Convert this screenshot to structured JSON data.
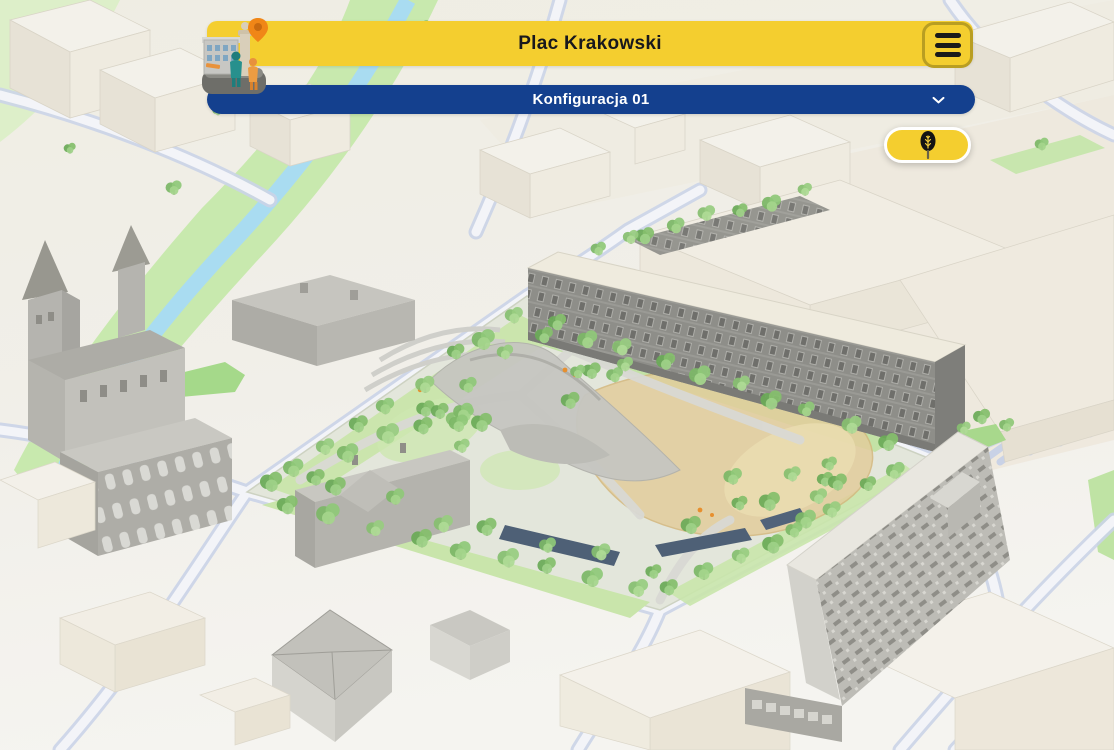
{
  "header": {
    "title": "Plac Krakowski",
    "logo_icon": "3d-city-model-logo",
    "menu_icon": "hamburger-menu-icon"
  },
  "config_selector": {
    "label": "Konfiguracja 01",
    "chevron_icon": "chevron-down-icon"
  },
  "map_controls": {
    "vegetation_button_icon": "tree-icon"
  },
  "map": {
    "view": "3D isometric city model of Plac Krakowski park and surrounding streets"
  },
  "colors": {
    "accent_yellow": "#F4CE2F",
    "accent_navy": "#14408E",
    "title_text": "#18181D",
    "menu_button_border": "#B99E22",
    "config_text": "#FFFFFF",
    "park_green": "#8FC878",
    "water_blue": "#A9DCF1",
    "sand_tan": "#E2CD9C",
    "road_edge": "#CBD4E8"
  }
}
